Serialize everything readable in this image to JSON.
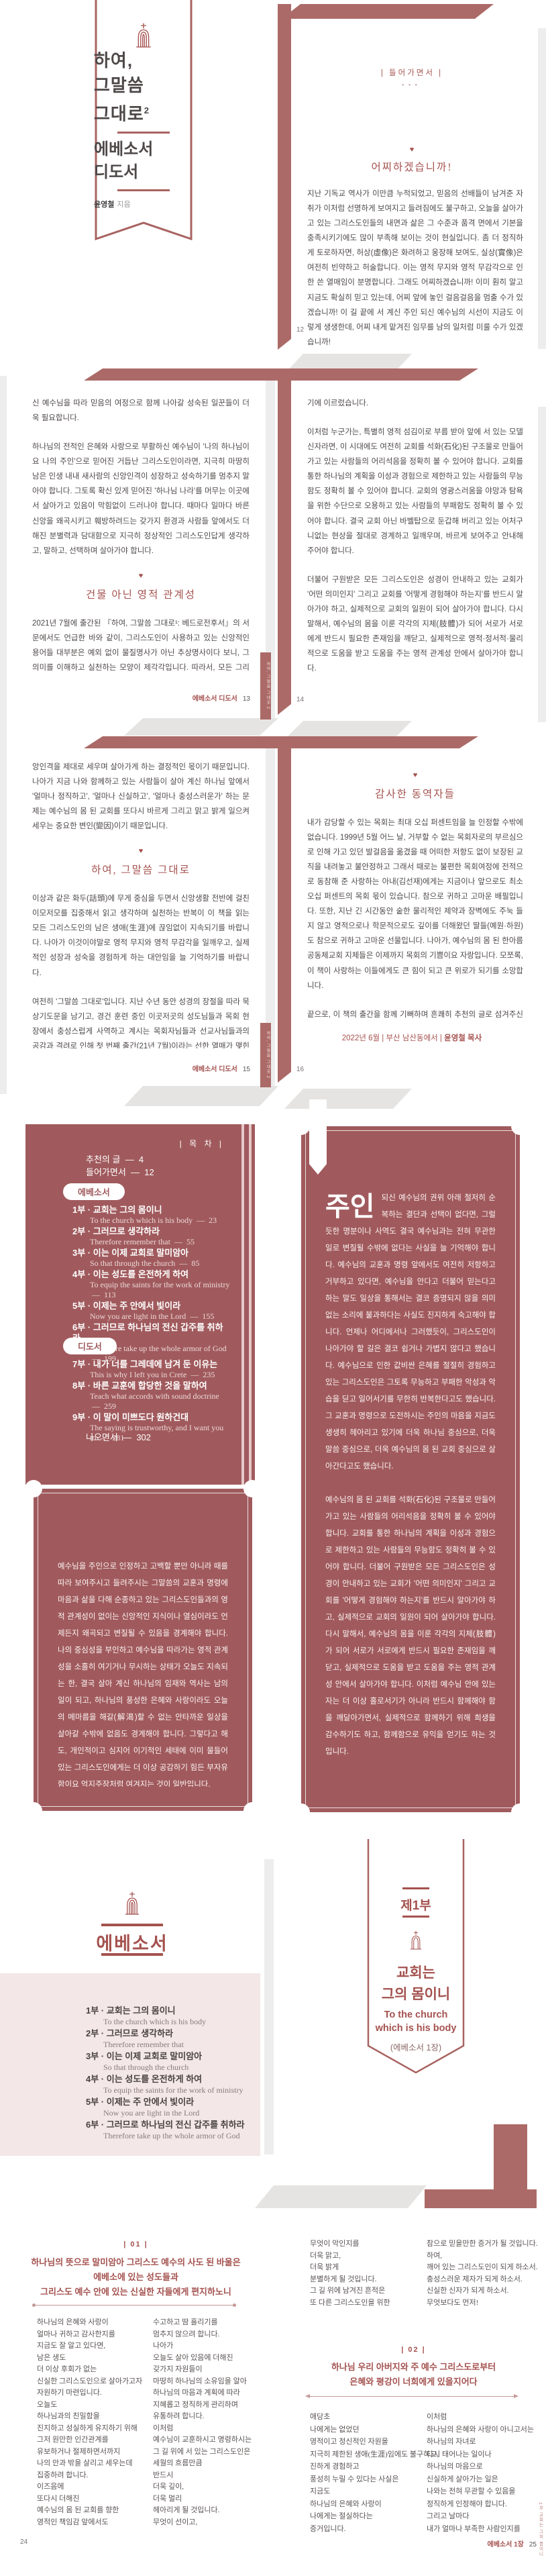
{
  "colors": {
    "mauve": "#a05a5d",
    "band": "#ab6a67",
    "heading_red": "#a4524f",
    "body_text": "#4e4848",
    "pink_panel": "#f3e7e7"
  },
  "cover": {
    "title_line1": "하여,",
    "title_line2": "그말씀",
    "title_line3": "그대로",
    "title_sup": "2",
    "sub_line1": "에베소서",
    "sub_line2": "디도서",
    "author": "윤영철",
    "author_suffix": "지음"
  },
  "page12": {
    "section_label": "|  들어가면서  |",
    "heading": "어찌하겠습니까!",
    "para1": "지난 기독교 역사가 이만큼 누적되었고, 믿음의 선배들이 남겨준 자취가 이처럼 선명하게 보여지고 들려짐에도 불구하고, 오늘을 살아가고 있는 그리스도인들의 내면과 삶은 그 수준과 품격 면에서 기본을 충족시키기에도 많이 부족해 보이는 것이 현실입니다. 좀 더 정직하게 토로하자면, 허상(虛像)은 화려하고 웅장해 보여도, 실상(實像)은 여전히 빈약하고 허술합니다. 이는 영적 무지와 영적 무감각으로 인한 쓴 열매임이 분명합니다. 그래도 어찌하겠습니까! 이미 훤히 알고 지금도 확실히 믿고 있는데, 어찌 앞에 놓인 걸음걸음을 멈출 수가 있겠습니까! 이 길 끝에 서 계신 주인 되신 예수님의 시선이 지금도 이렇게 생생한데, 어찌 내게 맡겨진 임무를 남의 일처럼 미룰 수가 있겠습니까!",
    "para2": "매 시대마다 살아 계신 하나님께서 찾고 찾으시는 믿음의 사람들이 절실하게 필요했듯이, 오늘도 앞으로도 예외 없이 믿음의 사람들이 더욱 필요합니다. 시작부터 마지막까지 그렇게 신실하게 살아가는 깨어 있는 그리스도인들이 더욱 필요합니다. 생명과 약속의 말씀이 '거짓 없는 진리'라는 사실을 증거하고 증명하는 제자들이 더욱 필요합니다. 그리고 부활하",
    "page_num": "12"
  },
  "page13": {
    "para1": "신 예수님을 따라 믿음의 여정으로 함께 나아갈 성숙된 일꾼들이 더욱 필요합니다.",
    "para2": "하나님의 전적인 은혜와 사랑으로 부활하신 예수님이 '나의 하나님이요 나의 주인'으로 믿어진 거듭난 그리스도인이라면, 지극히 마땅히 남은 인생 내내 새사람의 신앙인격이 성장하고 성숙하기를 멈추지 말아야 합니다. 그토록 확신 있게 믿어진 '하나님 나라'를 머무는 이곳에서 살아가고 있음이 막힘없이 드러나야 합니다. 때마다 일마다 바른 신앙을 왜곡시키고 훼방하려드는 갖가지 환경과 사람들 앞에서도 더해진 분별력과 담대함으로 지극히 정상적인 그리스도인답게 생각하고, 말하고, 선택하며 살아가야 합니다.",
    "heading": "건물 아닌 영적 관계성",
    "para3": "2021년 7월에 출간된 『하여, 그말씀 그대로¹: 베드로전후서』의 서문에서도 언급한 바와 같이, 그리스도인이 사용하고 있는 신앙적인 용어들 대부분은 예외 없이 물질명사가 아닌 추상명사이다 보니, 그 의미를 이해하고 실천하는 모양이 제각각입니다. 따라서, 모든 그리스도인의 이해와 실천을 위한 절대기준으로 '성경을 그 중심에 두어야 한다'고 강조했습니다. 그리고 때를 따라 보여지고 들려지는 용어들에 대한 그 의미를 바로 깨닫고 바로 믿을수록 아는 바와 믿는 바가 일치되고, 믿는 바와 행하는 바가 일치되는 신실한 삶을 살아가기 마련이라고 했습니다. 이제 때가 되어 『하여, 그말씀 그대로²: 에베소서·디도서』를 통해 '교회'와 '사역'이라고 하는 화두(話頭)로 넘어오게 되었습니다.",
    "para4": "'교회'라는 단어를 떠올리면 가장 먼저는 십자가가 더해진 건물 혹은 간판이 연상되고, 가슴 벅찬 감동이 일어나다가도 이내 왠지 모를 답답함에 그렇게 아쉽고 안타깝게 느껴지는 것이 일반이라고 해도 과장이 아닙니다. 이는 비단 오늘만의 문제가 아니라 초대교회 이후 지난 기독교 역사 전반에 걸쳐 반복적으로 이어져 내려온 현상이며, 앞으로도 크게 다르지 않을 듯, 심지어 더 왜곡되고 변질될 것이라고 해도 결코 무리가 아닙니다. 이즈음에 또다시 '교회는 무엇인가' 그리고 '교회는 어떠해야 하는가'를 진지하게 묻고 생각하며, 정직하게 답하",
    "footer_title": "에베소서 디도서",
    "page_num": "13",
    "side_tab": "하여, 그말씀 그대로 2"
  },
  "page14": {
    "para1": "기에 이르렀습니다.",
    "para2": "이처럼 누군가는, 특별히 영적 섬김이로 부름 받아 앞에 서 있는 모델 신자라면, 이 시대에도 여전히 교회를 석화(石化)된 구조물로 만들어가고 있는 사람들의 어리석음을 정확히 볼 수 있어야 합니다. 교회를 통한 하나님의 계획을 이성과 경험으로 제한하고 있는 사람들의 무능함도 정확히 볼 수 있어야 합니다. 교회의 영광스러움을 야망과 탐욕을 위한 수단으로 오용하고 있는 사람들의 부패함도 정확히 볼 수 있어야 합니다. 결국 교회 아닌 바벨탑으로 둔갑해 버리고 있는 어처구니없는 현상을 절대로 경계하고 일깨우며, 바르게 보여주고 안내해 주어야 합니다.",
    "para3": "더불어 구원받은 모든 그리스도인은 성경이 안내하고 있는 교회가 '어떤 의미인지' 그리고 교회를 '어떻게 경험해야 하는지'를 반드시 알아가야 하고, 실제적으로 교회의 일원이 되어 살아가야 합니다. 다시 말해서, 예수님의 몸을 이룬 각각의 지체(肢體)가 되어 서로가 서로에게 반드시 필요한 존재임을 깨닫고, 실제적으로 영적·정서적·물리적으로 도움을 받고 도움을 주는 영적 관계성 안에서 살아가야 합니다.",
    "heading": "경영 아닌 목양",
    "para4": "'교회'가 건물 아닌 영적 관계성으로 이루어진 예수님의 몸임을 인정하게 되면, '사역' 또한 조직을 원활하게 관리하고 효율을 극대화시키는 경영이 아닌, 함께한 그리스도인들과 한 몸이 되고, 함께 성장하고 성숙하며, 일상 속에서 소금과 빛으로 살아가도록 먼저 보여주고 섬기며 안내하는 목양임을 절감하게 될 것은 분명합니다. 영적 섬김이와 모델 신자로서의 정직함과 성실함은 함께한 영적 관계성을 더욱 건강하고 풍성하게 만들어주는 가장 중요한 출발입니다. 다시 말해서, 포도나무이신 예수님께 붙어 있는 원(原)가지로서의 책임감과 수고와 땀은 결국 예수님의 몸 된 교회를 교회되게 하는 기본 중의 기본입니다.",
    "page_num": "14"
  },
  "page15": {
    "para1": "앙인격을 제대로 세우며 살아가게 하는 결정적인 몫이기 때문입니다. 나아가 지금 나와 함께하고 있는 사람들이 살아 계신 하나님 앞에서 '얼마나 정직하고', '얼마나 신실하고', '얼마나 충성스러운가' 하는 문제는 예수님의 몸 된 교회를 또다시 바르게 그리고 맑고 밝게 일으켜 세우는 중요한 변인(變因)이기 때문입니다.",
    "heading": "하여, 그말씀 그대로",
    "para2": "이상과 같은 화두(話頭)에 무게 중심을 두면서 신앙생활 전반에 걸친 이모저모를 집중해서 읽고 생각하며 실천하는 반복이 이 책을 읽는 모든 그리스도인의 남은 생애(生涯)에 끊임없이 지속되기를 바랍니다. 나아가 이것이야말로 영적 무지와 영적 무감각을 일깨우고, 실제적인 성장과 성숙을 경험하게 하는 대안임을 늘 기억하기를 바랍니다.",
    "para3": "여전히 '그말씀 그대로'입니다. 지난 수년 동안 성경의 장절을 따라 묵상기도문을 남기고, 경건 훈련 중인 이곳저곳의 성도님들과 목회 현장에서 충성스럽게 사역하고 계시는 목회자님들과 선교사님들과의 공감과 격려로 인해 첫 번째 출간(21년 7월)이라는 선한 열매가 맺힌 것처럼, 이제 두 번째 책을 통해서도 더욱 많은 그리스도인들이 먼저는 '그리스도인이 된 자신을 위해서', 나아가 '시대와 환경과 사람과 교회를 향한 하나님 아버지의 마음을 깨닫고 회복하는데' 도움이 되었으면 하는 소망이 있습니다. 모쪼록, 부족한 이 책의 내용들이 '교회'와 '사역' 앞에 여전히 정직하고 신실하고 충성스럽게 서 있는 믿음의 사람들에게 이 모양 저 모양으로 힘과 위로가 되기를 간절히 기도합니다.",
    "footer_title": "에베소서 디도서",
    "page_num": "15",
    "side_tab": "하여, 그말씀 그대로 2"
  },
  "page16": {
    "heading": "감사한 동역자들",
    "para1": "내가 감당할 수 있는 목회는 최대 오십 퍼센트임을 늘 인정할 수밖에 없습니다. 1999년 5월 어느 날, 거부할 수 없는 목회자로의 부르심으로 인해 가고 있던 발걸음을 옮겼을 때 어떠한 저항도 없이 보장된 교직을 내려놓고 불안정하고 그래서 때로는 불편한 목회여정에 전적으로 동참해 준 사랑하는 아내(김선재)에게는 지금이나 앞으로도 최소 오십 퍼센트의 목회 몫이 있습니다. 참으로 귀하고 고마운 배필입니다. 또한, 지난 긴 시간동안 숱한 물리적인 제약과 장벽에도 주눅 들지 않고 영적으로나 학문적으로도 깊이를 더해왔던 딸들(예원·하원)도 참으로 귀하고 고마운 선물입니다. 나아가, 예수님의 몸 된 한아름공동체교회 지체들은 이제까지 목회의 기쁨이요 자랑입니다. 모쪼록, 이 책이 사랑하는 이들에게도 큰 힘이 되고 큰 위로가 되기를 소망합니다.",
    "para2": "끝으로, 이 책의 출간을 함께 기뻐하며 흔쾌히 추천의 글로 섬겨주신 김주철 목사님, 김현진 교수님, 오재수 목사님, 윤여준 변호사님, 이용준 목사님, 정백수 목사님, David Kim 목사님에게 감사드립니다. 또한, 이 책의 편집에서 발행에 이르기까지 모든 과정을 맡아 수고해주신 '예영커뮤니케이션' 원성삼 대표님과 직원분들에게도 감사드립니다. 아울러, 오늘이 있기까지 여러 모양으로 영적인 감흥과 일깨움을 더해주셨던 선후배 목사님들과 때마다 일마다 마음과 물질로 섬겨주셨던 선한 이웃들에게도 깊이 감사드립니다. 이 모든 것이 하나님의 은혜였습니다.",
    "sig_prefix": "2022년 6월 | 부산 남산동에서 |",
    "sig_name": "윤영철 목사",
    "page_num": "16"
  },
  "toc": {
    "header": "|  목 차  |",
    "dash": "—",
    "front": [
      {
        "label": "추천의 글",
        "page": "4"
      },
      {
        "label": "들어가면서",
        "page": "12"
      }
    ],
    "section1": "에베소서",
    "entries1": [
      {
        "ko": "1부 · 교회는 그의 몸이니",
        "en": "To the church which is his body",
        "page": "23"
      },
      {
        "ko": "2부 · 그러므로 생각하라",
        "en": "Therefore remember that",
        "page": "55"
      },
      {
        "ko": "3부 · 이는 이제 교회로 말미암아",
        "en": "So that through the church",
        "page": "85"
      },
      {
        "ko": "4부 · 이는 성도를 온전하게 하여",
        "en": "To equip the saints for the work of ministry",
        "page": "113"
      },
      {
        "ko": "5부 · 이제는 주 안에서 빛이라",
        "en": "Now you are light in the Lord",
        "page": "155"
      },
      {
        "ko": "6부 · 그러므로 하나님의 전신 갑주를 취하라",
        "en": "Therefore take up the whole armor of God",
        "page": "199"
      }
    ],
    "section2": "디도서",
    "entries2": [
      {
        "ko": "7부 · 내가 너를 그레데에 남겨 둔 이유는",
        "en": "This is why I left you in Crete",
        "page": "235"
      },
      {
        "ko": "8부 · 바른 교훈에 합당한 것을 말하여",
        "en": "Teach what accords with sound doctrine",
        "page": "259"
      },
      {
        "ko": "9부 · 이 말이 미쁘도다 원하건대",
        "en": "The saying is trustworthy, and I want you to",
        "page": "281"
      }
    ],
    "outro_label": "나오면서",
    "outro_page": "302"
  },
  "quote_left": {
    "para1": "예수님을 주인으로 인정하고 고백할 뿐만 아니라 때를 따라 보여주시고 들려주시는 그말씀의 교훈과 명령에 마음과 삶을 다해 순종하고 있는 그리스도인들과의 영적 관계성이 없이는 신앙적인 지식이나 열심이라도 언제든지 왜곡되고 변질될 수 있음을 경계해야 합니다. 나의 중심성을 부인하고 예수님을 따라가는 영적 관계성을 소홀히 여기거나 무시하는 상태가 오늘도 지속되는 한, 결국 살아 계신 하나님의 임재와 역사는 남의 일이 되고, 하나님의 풍성한 은혜와 사랑이라도 오늘의 메마름을 해갈(解渴)할 수 없는 안타까운 일상을 살아갈 수밖에 없음도 경계해야 합니다. 그렇다고 해도, 개인적이고 심지어 이기적인 세태에 이미 물들어 있는 그리스도인에게는 더 이상 공감하기 힘든 부자유함이요 억지주장처럼 여겨지는 것이 일반입니다.",
    "para2": "내가 먼저 겸손의 사람이 되고, 내가 먼저 순종의 사람이 되고, 내가 먼저 믿음의 사람이 되어야 합니다. 그리고 반드시 겸손의 사람과 함께해야 하고, 순종의 사람과 함께해야 하고, 믿음의 사람과 함께해야 합니다. 지금 나의 안과 밖이 머리 되신 예수님 앞에서 '얼마나 정직하고', '얼마나 신실하고', '얼마나 충성스러운가' 하는 문제는 모델 신자 된 나의 신앙인격을 제대로 세우며 살아가게 하는 결정적인 몫이기 때문입니다. 나아가 지금 나와 함께하고 있는 사람들이 살아 계신 하나님 앞에서 '얼마나 정직하고', '얼마나 신실하고', '얼마나 충성스러운가' 하는 문제는 예수님의 몸 된 교회를 또다시 바르게 그리고 맑고 밝게 일으켜 세우게 하는 중요한 변인(變因)이기 때문입니다."
  },
  "quote_right": {
    "lead": "주인",
    "para1": "되신 예수님의 권위 아래 철저히 순복하는 결단과 선택이 없다면, 그럴 듯한 명분이나 사역도 결국 예수님과는 전혀 무관한 일로 변질될 수밖에 없다는 사실을 늘 기억해야 합니다. 예수님의 교훈과 명령 앞에서도 여전히 저항하고 거부하고 있다면, 예수님을 안다고 더불어 믿는다고 하는 말도 일상을 통해서는 결코 증명되지 않을 의미없는 소리에 불과하다는 사실도 진지하게 숙고해야 합니다. 언제나 어디에서나 그러했듯이, 그리스도인이 나아가야 할 길은 결코 쉽거나 가볍지 않다고 했습니다. 예수님으로 인한 값비싼 은혜를 절절히 경험하고 있는 그리스도인은 그토록 무능하고 부패한 악성과 악습을 딛고 일어서기를 무한히 반복한다고도 했습니다. 그 교훈과 명령으로 도전하시는 주인의 마음을 지금도 생생히 헤아리고 있기에 더욱 하나님 중심으로, 더욱 말씀 중심으로, 더욱 예수님의 몸 된 교회 중심으로 살아간다고도 했습니다.",
    "para2": "예수님의 몸 된 교회를 석화(石化)된 구조물로 만들어가고 있는 사람들의 어리석음을 정확히 볼 수 있어야 합니다. 교회를 통한 하나님의 계획을 이성과 경험으로 제한하고 있는 사람들의 무능함도 정확히 볼 수 있어야 합니다. 더불어 구원받은 모든 그리스도인은 성경이 안내하고 있는 교회가 '어떤 의미인지' 그리고 교회를 '어떻게 경험해야 하는지'를 반드시 알아가야 하고, 실제적으로 교회의 일원이 되어 살아가야 합니다. 다시 말해서, 예수님의 몸을 이룬 각각의 지체(肢體)가 되어 서로가 서로에게 반드시 필요한 존재임을 깨닫고, 실제적으로 도움을 받고 도움을 주는 영적 관계성 안에서 살아가야 합니다. 이처럼 예수님 안에 있는 자는 더 이상 홀로서기가 아니라 반드시 함께해야 함을 깨달아가면서, 실제적으로 함께하기 위해 희생을 감수하기도 하고, 함께함으로 유익을 얻기도 하는 것입니다."
  },
  "part_divider": {
    "title": "에베소서",
    "entries": [
      {
        "ko": "1부 · 교회는 그의 몸이니",
        "en": "To the church which is his body"
      },
      {
        "ko": "2부 · 그러므로 생각하라",
        "en": "Therefore remember that"
      },
      {
        "ko": "3부 · 이는 이제 교회로 말미암아",
        "en": "So that through the church"
      },
      {
        "ko": "4부 · 이는 성도를 온전하게 하여",
        "en": "To equip the saints for the work of ministry"
      },
      {
        "ko": "5부 · 이제는 주 안에서 빛이라",
        "en": "Now you are light in the Lord"
      },
      {
        "ko": "6부 · 그러므로 하나님의 전신 갑주를 취하라",
        "en": "Therefore take up the whole armor of God"
      }
    ]
  },
  "part1": {
    "label": "제1부",
    "title_line1": "교회는",
    "title_line2": "그의 몸이니",
    "en_line1": "To the church",
    "en_line2": "which is his body",
    "ref": "(에베소서 1장)"
  },
  "page24": {
    "num_label": "|  01  |",
    "verse_lines": [
      "하나님의 뜻으로 말미암아 그리스도 예수의 사도 된 바울은",
      "에베소에 있는 성도들과",
      "그리스도 예수 안에 있는 신실한 자들에게 편지하노니"
    ],
    "col1": [
      "하나님의 은혜와 사랑이",
      "얼마나 귀하고 감사한지를",
      "지금도 잘 알고 있다면,",
      "남은 생도",
      "더 이상 후회가 없는",
      "신실한 그리스도인으로 살아가고자",
      "자원하기 마련입니다.",
      "오늘도",
      "하나님과의 친밀함을",
      "진지하고 성실하게 유지하기 위해",
      "그저 원만한 인간관계를",
      "유보하거나 절제하면서까지",
      "나의 안과 밖을 살리고 세우는데",
      "집중하려 합니다.",
      "이즈음에",
      "또다시 더해진",
      "예수님의 몸 된 교회를 향한",
      "영적인 책임감 앞에서도"
    ],
    "col2": [
      "수고하고 땀 흘리기를",
      "멈추지 않으려 합니다.",
      "나아가",
      "오늘도 살아 있음에 더해진",
      "갖가지 자원들이",
      "마땅히 하나님의 소유임을 알아",
      "하나님의 마음과 계획에 따라",
      "지혜롭고 정직하게 관리하며",
      "유통하려 합니다.",
      "이처럼",
      "예수님이 교훈하시고 명령하시는",
      "그 길 위에 서 있는 그리스도인은",
      "세월의 흐름만큼",
      "반드시",
      "더욱 깊이,",
      "더욱 멀리",
      "헤아리게 될 것입니다.",
      "무엇이 선이고,"
    ],
    "page_num": "24"
  },
  "page25": {
    "col1_top": [
      "무엇이 악인지를",
      "더욱 맑고,",
      "더욱 밝게",
      "분별하게 될 것입니다.",
      "그 길 위에 남겨진 흔적은",
      "또 다른 그리스도인을 위한"
    ],
    "col2_top": [
      "참으로 믿을만한 증거가 될 것입니다.",
      "하여,",
      "깨어 있는 그리스도인이 되게 하소서.",
      "충성스러운 제자가 되게 하소서.",
      "신실한 신자가 되게 하소서.",
      "무엇보다도 먼저!"
    ],
    "num_label": "|  02  |",
    "verse_lines": [
      "하나님 우리 아버지와 주 예수 그리스도로부터",
      "은혜와 평강이 너희에게 있을지어다"
    ],
    "col1": [
      "애당초",
      "나에게는 없었던",
      "영적이고 정신적인 자원을",
      "지극히 제한된 생애(生涯)임에도 불구하고,",
      "진하게 경험하고",
      "풍성히 누릴 수 있다는 사실은",
      "지금도",
      "하나님의 은혜와 사랑이",
      "나에게는 절실하다는",
      "증거입니다."
    ],
    "col2": [
      "이처럼",
      "하나님의 은혜와 사랑이 아니고서는",
      "하나님의 자녀로",
      "다시 태어나는 일이나",
      "하나님의 마음으로",
      "신실하게 살아가는 일은",
      "나와는 전혀 무관할 수 있음을",
      "정직하게 인정해야 합니다.",
      "그리고 날마다",
      "내가 얼마나 부족한 사람인지를"
    ],
    "footer_title": "에베소서 1장",
    "page_num": "25",
    "side_tab": "1부 교회는 그의 몸이니"
  }
}
